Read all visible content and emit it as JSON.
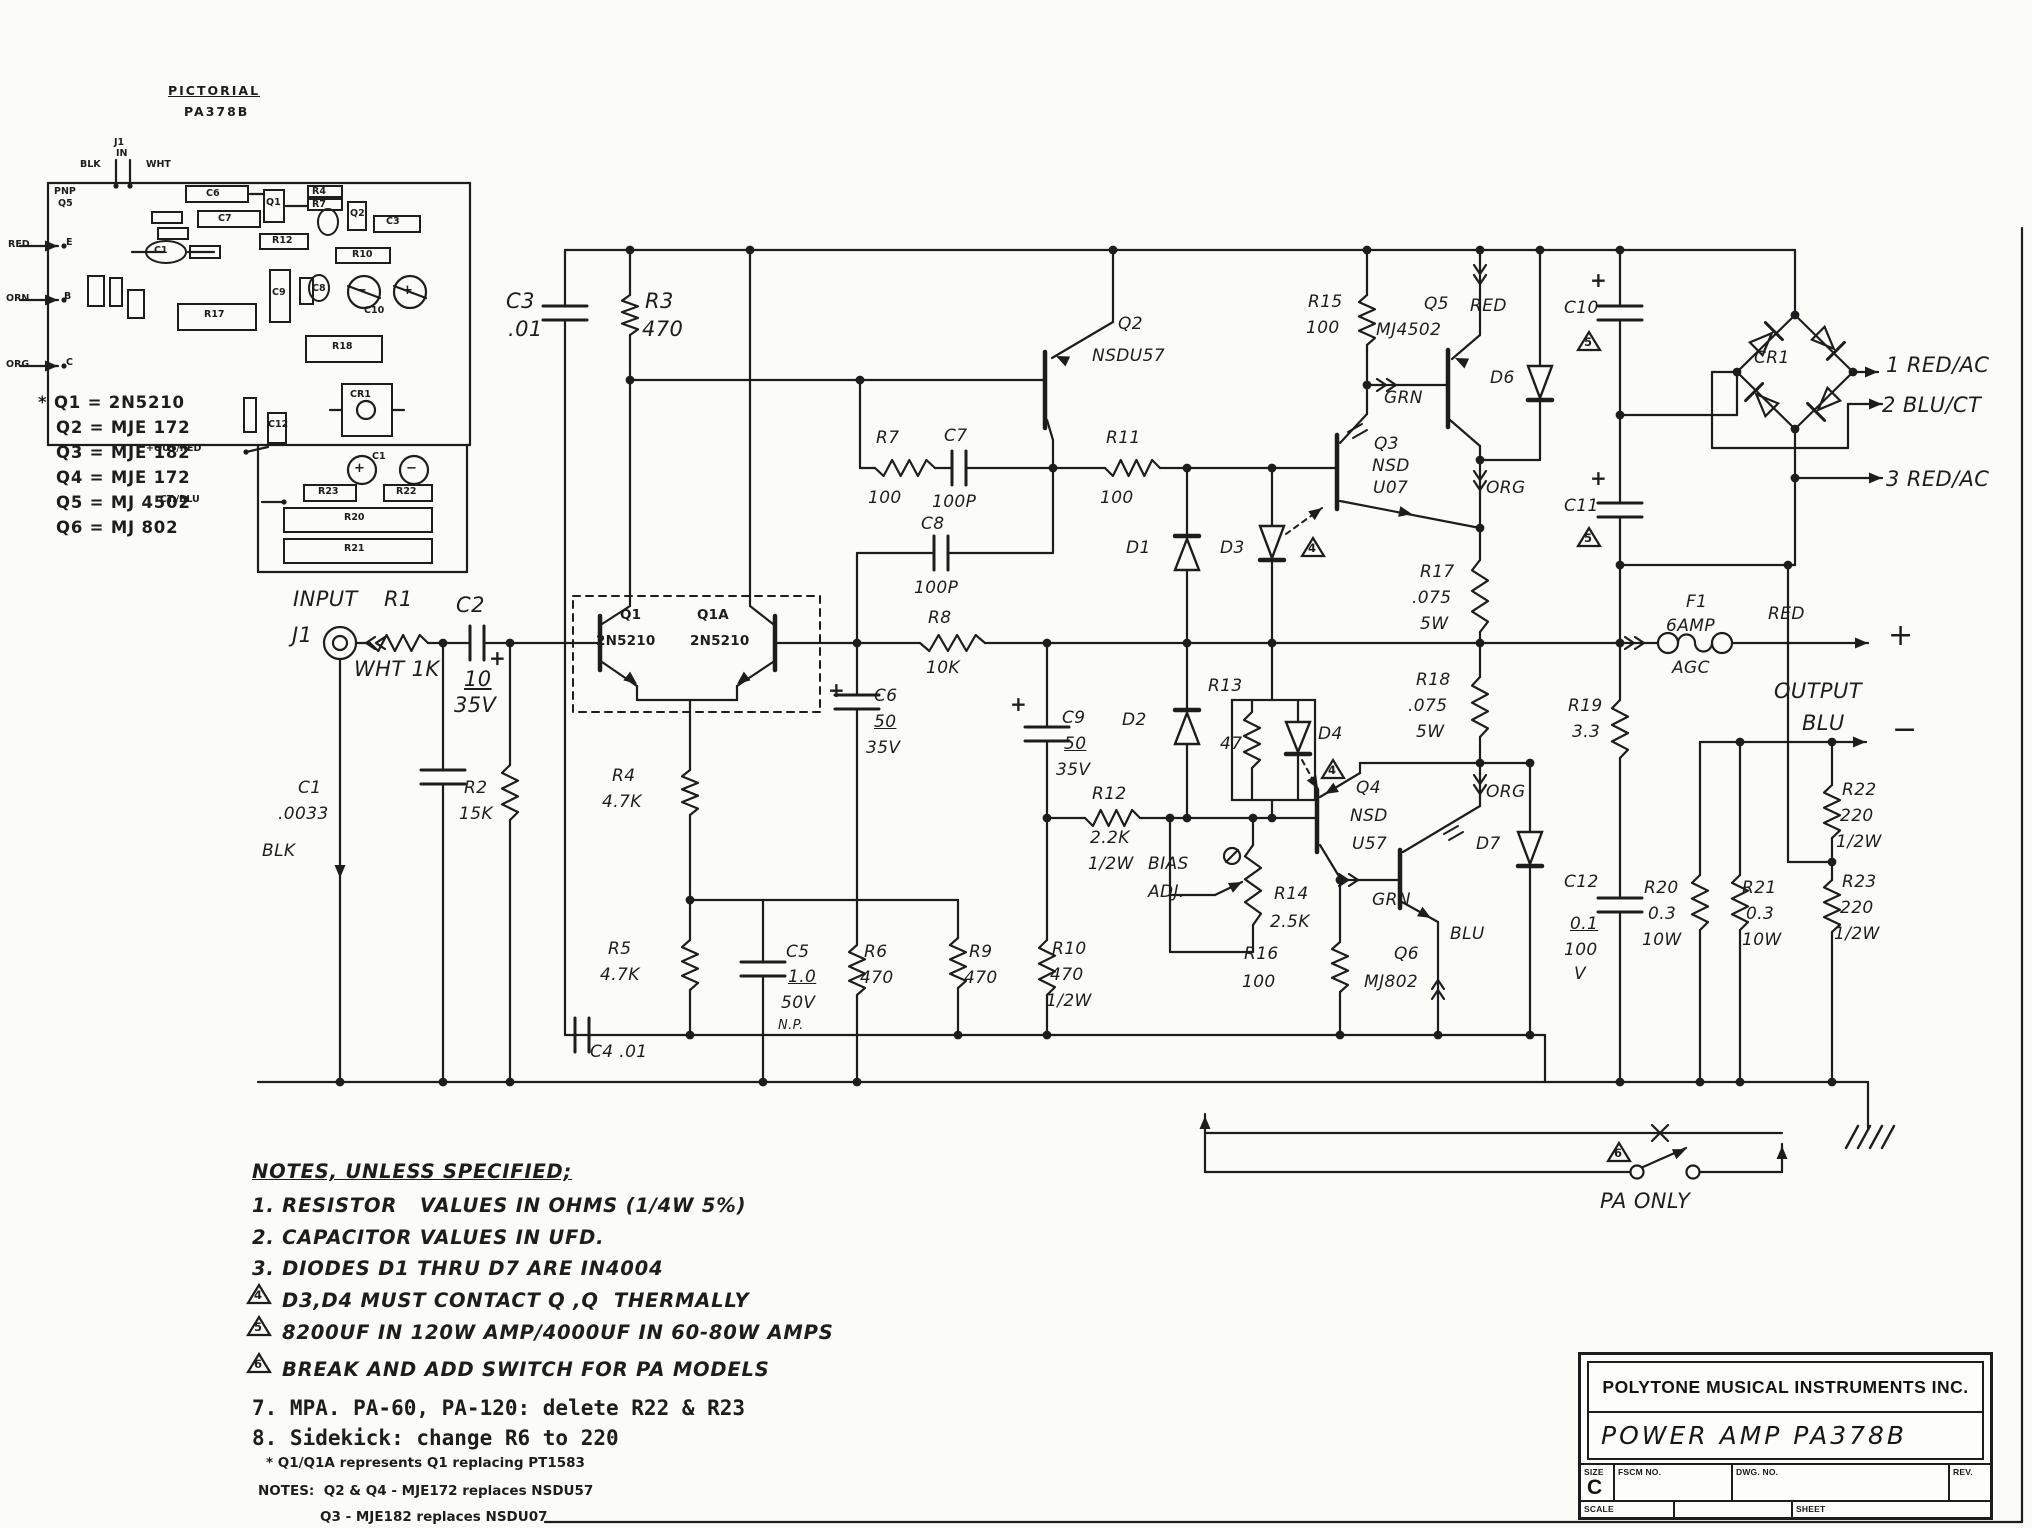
{
  "page": {
    "background": "#fbfbf8",
    "ink": "#1d1d1d"
  },
  "title_block": {
    "company": "POLYTONE MUSICAL INSTRUMENTS INC.",
    "product": "POWER AMP   PA378B",
    "size_label": "SIZE",
    "size": "C",
    "fscm": "FSCM NO.",
    "dwg": "DWG. NO.",
    "rev": "REV.",
    "scale": "SCALE",
    "sheet": "SHEET"
  },
  "legend": [
    "* Q1 = 2N5210",
    "Q2 = MJE 172",
    "Q3 = MJE 182",
    "Q4 = MJE 172",
    "Q5 = MJ 4502",
    "Q6 = MJ 802"
  ],
  "notes": [
    {
      "t": "NOTES, UNLESS SPECIFIED;",
      "c": "note nu"
    },
    {
      "t": "1. RESISTOR   VALUES IN OHMS (1/4W 5%)",
      "c": "note"
    },
    {
      "t": "2. CAPACITOR VALUES IN UFD.",
      "c": "note"
    },
    {
      "t": "3. DIODES D1 THRU D7 ARE IN4004",
      "c": "note"
    },
    {
      "t": "D3,D4 MUST CONTACT Q ,Q  THERMALLY",
      "c": "note",
      "x": 282
    },
    {
      "t": "8200UF IN 120W AMP/4000UF IN 60-80W AMPS",
      "c": "note",
      "x": 282
    },
    {
      "t": "BREAK AND ADD SWITCH FOR PA MODELS",
      "c": "note",
      "x": 282
    },
    {
      "t": "7. MPA. PA-60, PA-120: delete R22 & R23",
      "c": "mono"
    },
    {
      "t": "8. Sidekick: change R6 to 220",
      "c": "mono"
    },
    {
      "t": "* Q1/Q1A represents Q1 replacing PT1583",
      "c": "fine",
      "x": 266
    },
    {
      "t": "NOTES:  Q2 & Q4 - MJE172 replaces NSDU57",
      "c": "fine",
      "x": 258
    },
    {
      "t": "Q3 - MJE182 replaces NSDU07",
      "c": "fine",
      "x": 320
    }
  ],
  "labels": [
    [
      293,
      588,
      "INPUT",
      "lg"
    ],
    [
      384,
      588,
      "R1",
      "lg"
    ],
    [
      292,
      624,
      "J1",
      "lg"
    ],
    [
      354,
      658,
      "WHT 1K",
      "lg"
    ],
    [
      456,
      594,
      "C2",
      "lg"
    ],
    [
      464,
      668,
      "10",
      "lg un"
    ],
    [
      454,
      694,
      "35V",
      "lg"
    ],
    [
      489,
      648,
      "+",
      "pl"
    ],
    [
      298,
      780,
      "C1",
      ""
    ],
    [
      278,
      806,
      ".0033",
      ""
    ],
    [
      262,
      843,
      "BLK",
      ""
    ],
    [
      464,
      780,
      "R2",
      ""
    ],
    [
      459,
      806,
      "15K",
      ""
    ],
    [
      506,
      290,
      "C3",
      "lg"
    ],
    [
      508,
      318,
      ".01",
      "lg"
    ],
    [
      645,
      290,
      "R3",
      "lg"
    ],
    [
      642,
      318,
      "470",
      "lg"
    ],
    [
      620,
      608,
      "Q1",
      "b13"
    ],
    [
      596,
      634,
      "2N5210",
      "b13"
    ],
    [
      697,
      608,
      "Q1A",
      "b13"
    ],
    [
      690,
      634,
      "2N5210",
      "b13"
    ],
    [
      612,
      768,
      "R4",
      ""
    ],
    [
      602,
      794,
      "4.7K",
      ""
    ],
    [
      608,
      941,
      "R5",
      ""
    ],
    [
      600,
      967,
      "4.7K",
      ""
    ],
    [
      786,
      944,
      "C5",
      ""
    ],
    [
      788,
      969,
      "1.0",
      "un"
    ],
    [
      781,
      995,
      "50V",
      ""
    ],
    [
      778,
      1019,
      "N.P.",
      "s"
    ],
    [
      864,
      944,
      "R6",
      ""
    ],
    [
      860,
      970,
      "470",
      ""
    ],
    [
      969,
      944,
      "R9",
      ""
    ],
    [
      964,
      970,
      "470",
      ""
    ],
    [
      590,
      1044,
      "C4 .01",
      ""
    ],
    [
      876,
      430,
      "R7",
      ""
    ],
    [
      868,
      490,
      "100",
      ""
    ],
    [
      944,
      428,
      "C7",
      ""
    ],
    [
      932,
      494,
      "100P",
      ""
    ],
    [
      921,
      516,
      "C8",
      ""
    ],
    [
      914,
      580,
      "100P",
      ""
    ],
    [
      1106,
      430,
      "R11",
      ""
    ],
    [
      1100,
      490,
      "100",
      ""
    ],
    [
      928,
      610,
      "R8",
      ""
    ],
    [
      926,
      660,
      "10K",
      ""
    ],
    [
      1118,
      316,
      "Q2",
      ""
    ],
    [
      1092,
      348,
      "NSDU57",
      ""
    ],
    [
      828,
      680,
      "+",
      "pl"
    ],
    [
      874,
      688,
      "C6",
      ""
    ],
    [
      874,
      714,
      "50",
      "un"
    ],
    [
      866,
      740,
      "35V",
      ""
    ],
    [
      1010,
      694,
      "+",
      "pl"
    ],
    [
      1062,
      710,
      "C9",
      ""
    ],
    [
      1064,
      736,
      "50",
      "un"
    ],
    [
      1056,
      762,
      "35V",
      ""
    ],
    [
      1052,
      941,
      "R10",
      ""
    ],
    [
      1050,
      967,
      "470",
      ""
    ],
    [
      1046,
      993,
      "1/2W",
      ""
    ],
    [
      1126,
      540,
      "D1",
      ""
    ],
    [
      1122,
      712,
      "D2",
      ""
    ],
    [
      1220,
      540,
      "D3",
      ""
    ],
    [
      1208,
      678,
      "R13",
      ""
    ],
    [
      1220,
      736,
      "47",
      ""
    ],
    [
      1318,
      726,
      "D4",
      ""
    ],
    [
      1092,
      786,
      "R12",
      ""
    ],
    [
      1090,
      830,
      "2.2K",
      ""
    ],
    [
      1088,
      856,
      "1/2W",
      ""
    ],
    [
      1148,
      856,
      "BIAS",
      ""
    ],
    [
      1148,
      884,
      "ADJ.",
      ""
    ],
    [
      1274,
      886,
      "R14",
      ""
    ],
    [
      1270,
      914,
      "2.5K",
      ""
    ],
    [
      1356,
      780,
      "Q4",
      ""
    ],
    [
      1350,
      808,
      "NSD",
      ""
    ],
    [
      1352,
      836,
      "U57",
      ""
    ],
    [
      1244,
      946,
      "R16",
      ""
    ],
    [
      1242,
      974,
      "100",
      ""
    ],
    [
      1394,
      946,
      "Q6",
      ""
    ],
    [
      1364,
      974,
      "MJ802",
      ""
    ],
    [
      1372,
      892,
      "GRN",
      ""
    ],
    [
      1450,
      926,
      "BLU",
      ""
    ],
    [
      1476,
      836,
      "D7",
      ""
    ],
    [
      1486,
      784,
      "ORG",
      ""
    ],
    [
      1308,
      294,
      "R15",
      ""
    ],
    [
      1306,
      320,
      "100",
      ""
    ],
    [
      1424,
      296,
      "Q5",
      ""
    ],
    [
      1376,
      322,
      "MJ4502",
      ""
    ],
    [
      1470,
      298,
      "RED",
      ""
    ],
    [
      1490,
      370,
      "D6",
      ""
    ],
    [
      1384,
      390,
      "GRN",
      ""
    ],
    [
      1486,
      480,
      "ORG",
      ""
    ],
    [
      1420,
      564,
      "R17",
      ""
    ],
    [
      1412,
      590,
      ".075",
      ""
    ],
    [
      1420,
      616,
      "5W",
      ""
    ],
    [
      1416,
      672,
      "R18",
      ""
    ],
    [
      1408,
      698,
      ".075",
      ""
    ],
    [
      1416,
      724,
      "5W",
      ""
    ],
    [
      1374,
      436,
      "Q3",
      ""
    ],
    [
      1372,
      458,
      "NSD",
      ""
    ],
    [
      1373,
      480,
      "U07",
      ""
    ],
    [
      1564,
      300,
      "C10",
      ""
    ],
    [
      1590,
      270,
      "+",
      "pl"
    ],
    [
      1564,
      498,
      "C11",
      ""
    ],
    [
      1590,
      468,
      "+",
      "pl"
    ],
    [
      1754,
      350,
      "CR1",
      ""
    ],
    [
      1886,
      354,
      "1 RED/AC",
      "lg"
    ],
    [
      1882,
      394,
      "2 BLU/CT",
      "lg"
    ],
    [
      1886,
      468,
      "3 RED/AC",
      "lg"
    ],
    [
      1686,
      594,
      "F1",
      ""
    ],
    [
      1666,
      618,
      "6AMP",
      ""
    ],
    [
      1672,
      660,
      "AGC",
      ""
    ],
    [
      1768,
      606,
      "RED",
      ""
    ],
    [
      1888,
      620,
      "+",
      "xl"
    ],
    [
      1774,
      680,
      "OUTPUT",
      "lg"
    ],
    [
      1802,
      712,
      "BLU",
      "lg"
    ],
    [
      1892,
      714,
      "−",
      "xl"
    ],
    [
      1568,
      698,
      "R19",
      ""
    ],
    [
      1572,
      724,
      "3.3",
      ""
    ],
    [
      1564,
      874,
      "C12",
      ""
    ],
    [
      1570,
      916,
      "0.1",
      "un"
    ],
    [
      1564,
      942,
      "100",
      ""
    ],
    [
      1574,
      966,
      "V",
      ""
    ],
    [
      1644,
      880,
      "R20",
      ""
    ],
    [
      1648,
      906,
      "0.3",
      ""
    ],
    [
      1642,
      932,
      "10W",
      ""
    ],
    [
      1742,
      880,
      "R21",
      ""
    ],
    [
      1746,
      906,
      "0.3",
      ""
    ],
    [
      1742,
      932,
      "10W",
      ""
    ],
    [
      1842,
      782,
      "R22",
      ""
    ],
    [
      1840,
      808,
      "220",
      ""
    ],
    [
      1836,
      834,
      "1/2W",
      ""
    ],
    [
      1842,
      874,
      "R23",
      ""
    ],
    [
      1840,
      900,
      "220",
      ""
    ],
    [
      1834,
      926,
      "1/2W",
      ""
    ],
    [
      1600,
      1190,
      "PA ONLY",
      "lg"
    ],
    [
      1584,
      336,
      "5",
      "tn"
    ],
    [
      1584,
      532,
      "5",
      "tn"
    ],
    [
      1308,
      542,
      "4",
      "tn"
    ],
    [
      1328,
      764,
      "4",
      "tn"
    ],
    [
      1614,
      1147,
      "6",
      "tn"
    ],
    [
      254,
      1289,
      "4",
      "tn"
    ],
    [
      254,
      1321,
      "5",
      "tn"
    ],
    [
      254,
      1358,
      "6",
      "tn"
    ],
    [
      168,
      84,
      "PICTORIAL",
      "phu"
    ],
    [
      184,
      105,
      "PA378B",
      "ph"
    ],
    [
      54,
      187,
      "PNP",
      "p"
    ],
    [
      58,
      199,
      "Q5",
      "p"
    ],
    [
      8,
      240,
      "RED",
      "p"
    ],
    [
      6,
      294,
      "ORN",
      "p"
    ],
    [
      6,
      360,
      "ORG",
      "p"
    ],
    [
      66,
      238,
      "E",
      "p"
    ],
    [
      64,
      292,
      "B",
      "p"
    ],
    [
      66,
      358,
      "C",
      "p"
    ],
    [
      114,
      138,
      "J1",
      "p"
    ],
    [
      116,
      149,
      "IN",
      "p"
    ],
    [
      80,
      160,
      "BLK",
      "p"
    ],
    [
      146,
      160,
      "WHT",
      "p"
    ],
    [
      206,
      189,
      "C6",
      "p"
    ],
    [
      218,
      214,
      "C7",
      "p"
    ],
    [
      266,
      198,
      "Q1",
      "p"
    ],
    [
      312,
      187,
      "R4",
      "p"
    ],
    [
      312,
      200,
      "R7",
      "p"
    ],
    [
      350,
      209,
      "Q2",
      "p"
    ],
    [
      272,
      236,
      "R12",
      "p"
    ],
    [
      352,
      250,
      "R10",
      "p"
    ],
    [
      386,
      217,
      "C3",
      "p"
    ],
    [
      272,
      288,
      "C9",
      "p"
    ],
    [
      312,
      284,
      "C8",
      "p"
    ],
    [
      154,
      246,
      "C1",
      "p"
    ],
    [
      204,
      310,
      "R17",
      "p"
    ],
    [
      332,
      342,
      "R18",
      "p"
    ],
    [
      350,
      390,
      "CR1",
      "p"
    ],
    [
      364,
      306,
      "C10",
      "p"
    ],
    [
      268,
      420,
      "C12",
      "p"
    ],
    [
      318,
      487,
      "R23",
      "p"
    ],
    [
      396,
      487,
      "R22",
      "p"
    ],
    [
      344,
      513,
      "R20",
      "p"
    ],
    [
      344,
      544,
      "R21",
      "p"
    ],
    [
      372,
      452,
      "C1",
      "p"
    ],
    [
      356,
      284,
      "−",
      "pc"
    ],
    [
      402,
      284,
      "+",
      "pc"
    ],
    [
      354,
      462,
      "+",
      "pc"
    ],
    [
      406,
      462,
      "−",
      "pc"
    ],
    [
      146,
      444,
      "+OUT/RED",
      "p"
    ],
    [
      160,
      495,
      "CT./BLU",
      "p"
    ]
  ]
}
